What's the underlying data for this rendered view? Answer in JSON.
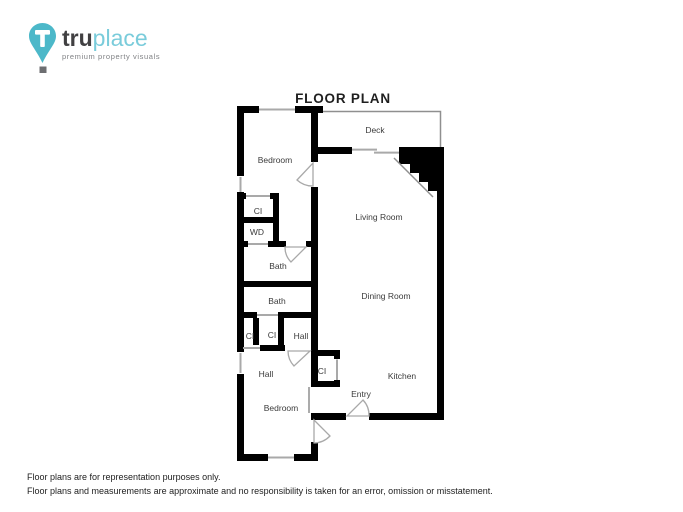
{
  "logo": {
    "brand_bold": "tru",
    "brand_light": "place",
    "tagline": "premium property visuals",
    "pin_letter": "T"
  },
  "colors": {
    "wall": "#000000",
    "fixture_line": "#a9a9a9",
    "logo_teal": "#4cb8c9",
    "logo_teal_light": "#7accdb",
    "logo_dark": "#414042",
    "logo_gray": "#808285"
  },
  "plan": {
    "title": "FLOOR PLAN",
    "rooms": [
      "Deck",
      "Bedroom",
      "CI",
      "WD",
      "Living Room",
      "Bath",
      "Bath",
      "Dining Room",
      "CI",
      "CI",
      "Hall",
      "CI",
      "Hall",
      "Kitchen",
      "Entry",
      "Bedroom"
    ]
  },
  "footer": {
    "line1": "Floor plans are for representation purposes only.",
    "line2": "Floor plans and measurements are approximate and no responsibility is taken for an error, omission or misstatement."
  }
}
